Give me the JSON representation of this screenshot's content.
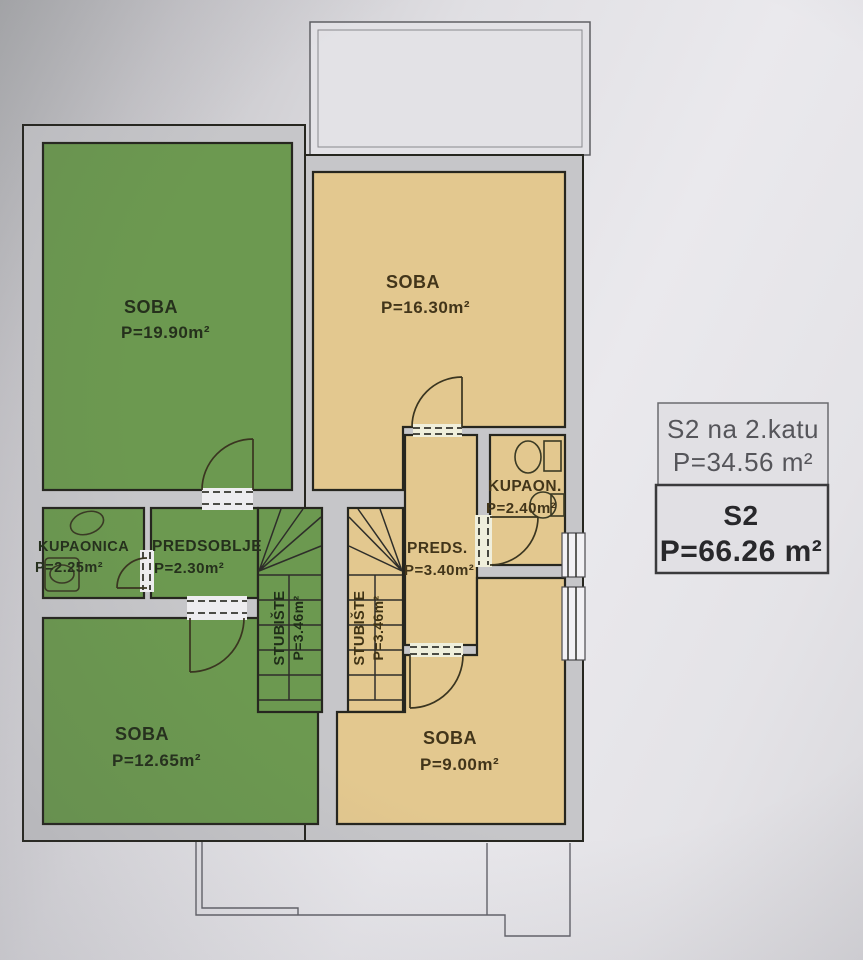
{
  "legend": {
    "upper": {
      "line1": "S2 na 2.katu",
      "line2": "P=34.56 m²"
    },
    "lower": {
      "name": "S2",
      "area": "P=66.26 m²"
    }
  },
  "rooms": [
    {
      "id": "soba-1",
      "name": "SOBA",
      "area": "P=19.90m²"
    },
    {
      "id": "soba-2",
      "name": "SOBA",
      "area": "P=16.30m²"
    },
    {
      "id": "kupaonica",
      "name": "KUPAONICA",
      "area": "P=2.25m²"
    },
    {
      "id": "predsoblje",
      "name": "PREDSOBLJE",
      "area": "P=2.30m²"
    },
    {
      "id": "preds",
      "name": "PREDS.",
      "area": "P=3.40m²"
    },
    {
      "id": "kupaon",
      "name": "KUPAON.",
      "area": "P=2.40m²"
    },
    {
      "id": "stubiste-left",
      "name": "STUBIŠTE",
      "area": "P=3.46m²"
    },
    {
      "id": "stubiste-right",
      "name": "STUBIŠTE",
      "area": "P=3.46m²"
    },
    {
      "id": "soba-3",
      "name": "SOBA",
      "area": "P=12.65m²"
    },
    {
      "id": "soba-4",
      "name": "SOBA",
      "area": "P=9.00m²"
    }
  ],
  "colors": {
    "green_room": "#6c9950",
    "yellow_room": "#e3c88f",
    "wall_fill": "#c6c6c9",
    "line_dark": "#26261f",
    "legend_text_muted": "#55555a",
    "legend_text_dark": "#28282b",
    "legend_border_upper": "#6b6b6f",
    "legend_border_lower": "#3a3a3c"
  }
}
